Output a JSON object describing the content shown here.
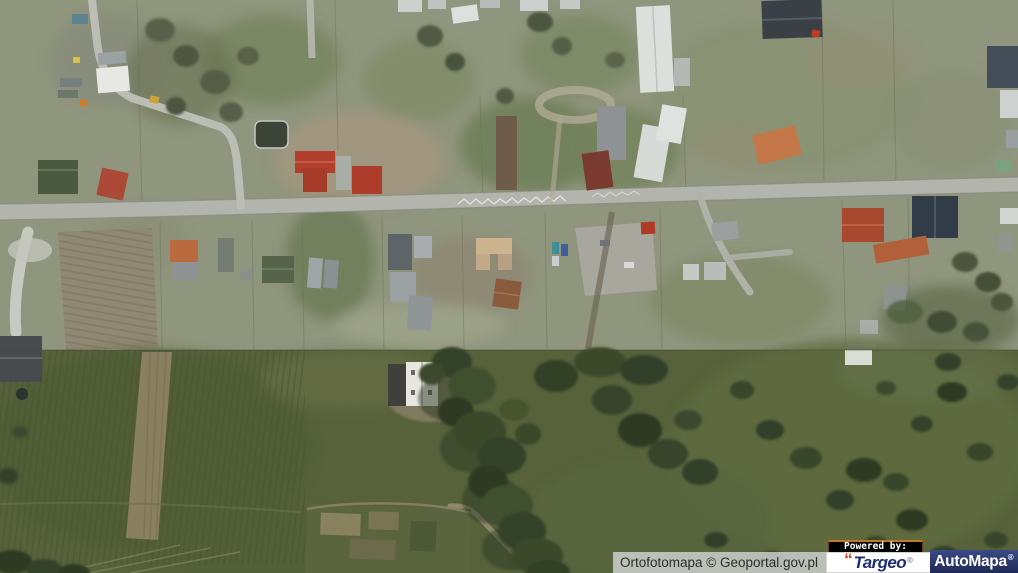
{
  "map": {
    "kind": "aerial-orthophoto",
    "colors": {
      "terrain_upper": "#90957d",
      "terrain_lower": "#57623b",
      "road": "#b3b5ad",
      "attribution_bg": "#cdcfcc",
      "targeo_text": "#1c2e74",
      "targeo_mark": "#e13a17",
      "automapa_bg": "#2b3a6e",
      "powered_by_bg": "#000000"
    }
  },
  "attribution": {
    "text": "Ortofotomapa © Geoportal.gov.pl"
  },
  "logos": {
    "powered_by": "Powered by:",
    "targeo": {
      "mark": "“",
      "name": "Targeo",
      "registered": "®"
    },
    "automapa": {
      "name": "AutoMapa",
      "registered": "®"
    }
  }
}
